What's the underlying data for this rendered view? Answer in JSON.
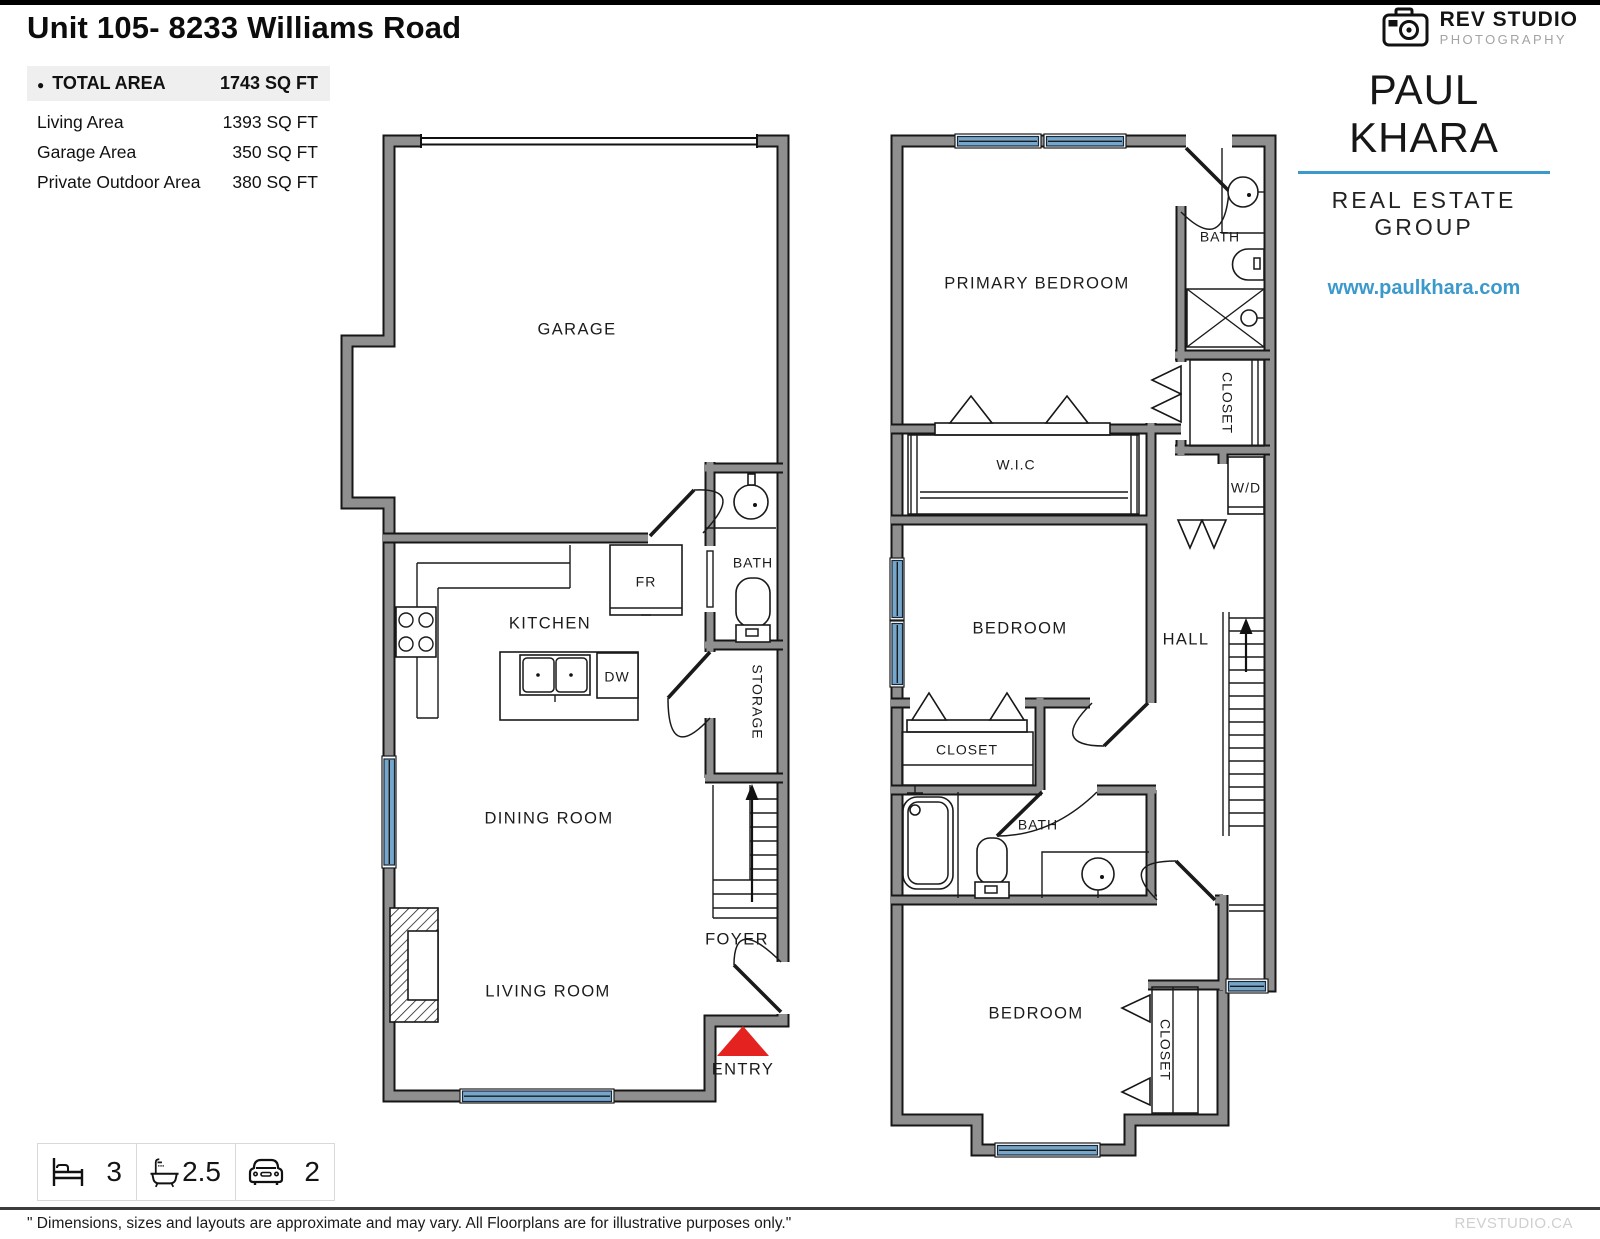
{
  "page": {
    "title": "Unit 105- 8233 Williams Road"
  },
  "branding": {
    "studio_name": "REV STUDIO",
    "studio_sub": "PHOTOGRAPHY",
    "agent_name": "PAUL KHARA",
    "agent_group": "REAL ESTATE GROUP",
    "agent_site": "www.paulkhara.com"
  },
  "areas": {
    "bullet": "●",
    "total_label": "TOTAL AREA",
    "total_value": "1743 SQ FT",
    "rows": [
      {
        "label": "Living Area",
        "value": "1393 SQ FT"
      },
      {
        "label": "Garage Area",
        "value": "350 SQ FT"
      },
      {
        "label": "Private Outdoor Area",
        "value": "380 SQ FT"
      }
    ]
  },
  "floor1": {
    "labels": {
      "garage": "GARAGE",
      "kitchen": "KITCHEN",
      "fridge": "FR",
      "dishwasher": "DW",
      "bath": "BATH",
      "storage": "STORAGE",
      "dining": "DINING ROOM",
      "living": "LIVING ROOM",
      "foyer": "FOYER",
      "entry": "ENTRY"
    }
  },
  "floor2": {
    "labels": {
      "primary": "PRIMARY BEDROOM",
      "bath_upper": "BATH",
      "closet_upper": "CLOSET",
      "washer_dryer": "W/D",
      "wic": "W.I.C",
      "bedroom_mid": "BEDROOM",
      "hall": "HALL",
      "closet_mid": "CLOSET",
      "bath_lower": "BATH",
      "bedroom_lower": "BEDROOM",
      "closet_lower": "CLOSET"
    }
  },
  "stats": {
    "beds": "3",
    "baths": "2.5",
    "parking": "2"
  },
  "footer": {
    "disclaimer": "\" Dimensions, sizes and layouts are approximate and may vary. All Floorplans are for illustrative purposes only.\"",
    "brand": "REVSTUDIO.CA"
  },
  "colors": {
    "wall": "#8f8f8f",
    "window": "#77a6cb",
    "accent": "#3b99cc",
    "entry_red": "#e42320"
  }
}
